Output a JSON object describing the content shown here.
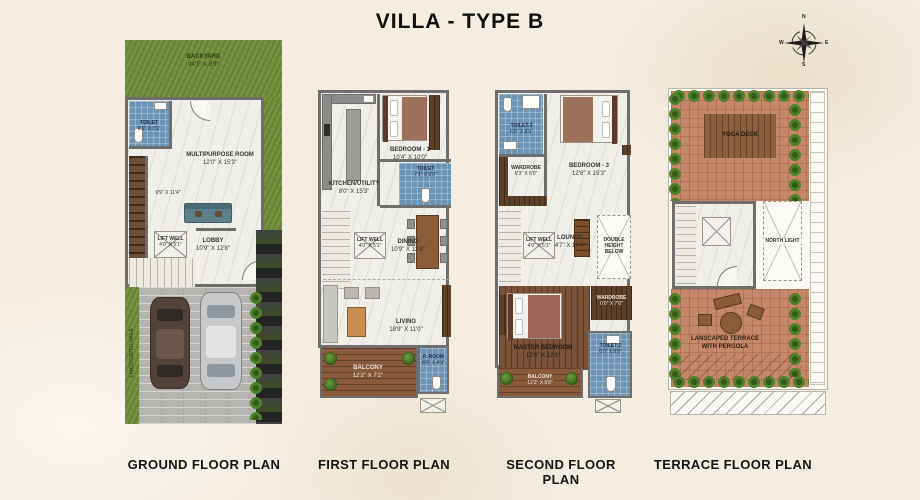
{
  "title": "VILLA - TYPE B",
  "palette": {
    "background": "#f4ede0",
    "grass_green": "#75913d",
    "tile_blue": "#6c92b4",
    "wood_deck": "#8a5a3d",
    "terracotta": "#c6886a",
    "wall_grey": "#6e6e6e",
    "marble": "#f1efe9"
  },
  "compass": {
    "n": "N",
    "e": "E",
    "s": "S",
    "w": "W"
  },
  "plans": [
    {
      "label": "GROUND FLOOR PLAN",
      "rooms": {
        "backyard": {
          "name": "BACKYARD",
          "dim": "24'3\" X 8'9\""
        },
        "toilet": {
          "name": "TOILET",
          "dim": "6'5\" X 7'1\""
        },
        "multipurpose": {
          "name": "MULTIPURPOSE ROOM",
          "dim": "12'0\" X 15'3\""
        },
        "stair_hall": {
          "dim": "6'9\" X 11'4\""
        },
        "liftwell": {
          "name": "LIFT WELL",
          "dim": "4'0\" X 5'1\""
        },
        "lobby": {
          "name": "LOBBY",
          "dim": "10'9\" X 12'8\""
        },
        "landscaped": {
          "name": "LANDSCAPED AREA"
        }
      }
    },
    {
      "label": "FIRST FLOOR PLAN",
      "rooms": {
        "kitchen": {
          "name": "KITCHEN/UTILITY",
          "dim": "8'0\" X 15'3\""
        },
        "bedroom1": {
          "name": "BEDROOM - 1",
          "dim": "10'4\" X 10'0\""
        },
        "toilet1": {
          "name": "TOILET",
          "dim": "7'1\" X 5'0\""
        },
        "liftwell": {
          "name": "LIFT WELL",
          "dim": "4'0\" X 5'1\""
        },
        "dining": {
          "name": "DINING",
          "dim": "10'9\" X 12'4\""
        },
        "living": {
          "name": "LIVING",
          "dim": "18'9\" X 11'0\""
        },
        "balcony": {
          "name": "BALCONY",
          "dim": "12'2\" X 7'2\""
        },
        "proom": {
          "name": "P. ROOM",
          "dim": "8'0\" X 4'9\""
        }
      }
    },
    {
      "label": "SECOND FLOOR PLAN",
      "rooms": {
        "toilet3": {
          "name": "TOILET-3",
          "dim": "6'0\" X 8'9\""
        },
        "wardrobe": {
          "name": "WARDROBE",
          "dim": "6'3\" X 6'0\""
        },
        "bedroom3": {
          "name": "BEDROOM - 3",
          "dim": "12'6\" X 15'3\""
        },
        "liftwell": {
          "name": "LIFT WELL",
          "dim": "4'0\" X 5'1\""
        },
        "lounge": {
          "name": "LOUNGE",
          "dim": "4'7\" X 12'4\""
        },
        "doubleheight": {
          "name": "DOUBLE HEIGHT BELOW"
        },
        "wardrobe2": {
          "name": "WARDROBE",
          "dim": "6'0\" X 7'0\""
        },
        "master": {
          "name": "MASTER BEDROOM",
          "dim": "12'6\" X 12'6\""
        },
        "toilet2": {
          "name": "TOILET-2",
          "dim": "6'0\" X 8'9\""
        },
        "balcony": {
          "name": "BALCONY",
          "dim": "12'2\" X 5'8\""
        }
      }
    },
    {
      "label": "TERRACE FLOOR PLAN",
      "rooms": {
        "yoga": {
          "name": "YOGA DECK"
        },
        "northlight": {
          "name": "NORTH LIGHT"
        },
        "terrace": {
          "name": "LANSCAPED TERRACE WITH PERGOLA"
        }
      }
    }
  ]
}
